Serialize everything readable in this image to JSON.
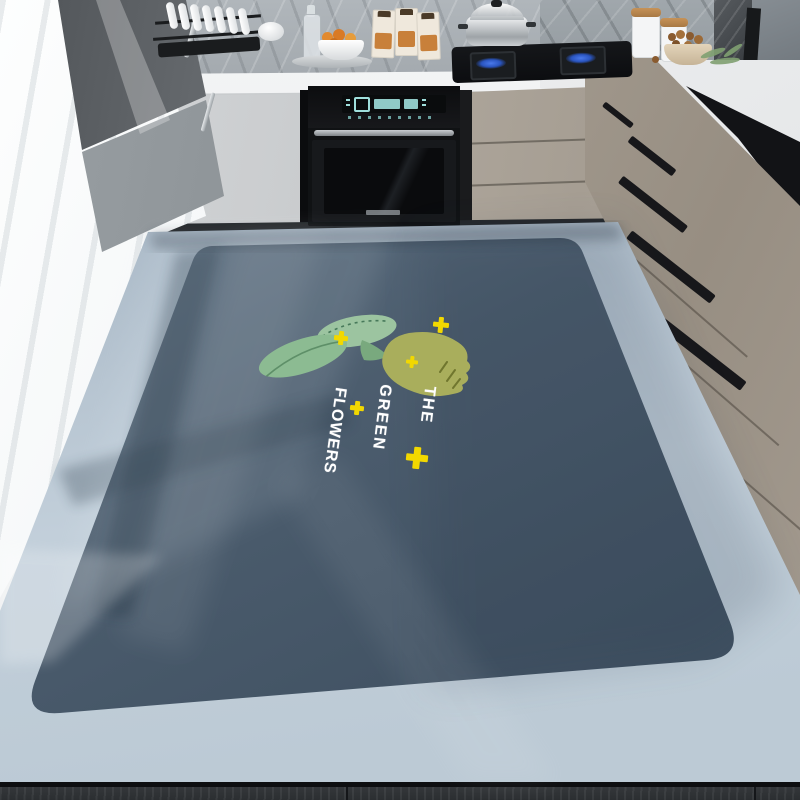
{
  "mat": {
    "text_lines": [
      "THE",
      "GREEN",
      "FLOWERS"
    ],
    "phrase": "THE GREEN FLOWERS",
    "colors": {
      "surface": "#4A5B6C",
      "surface_shadow": "#3A4A5A",
      "border": "#BCC9D4",
      "flower": "#A9AE5C",
      "leaf": "#8FBD95",
      "sparkle": "#F2D800",
      "text": "#FFFFFF"
    },
    "sparkles": [
      {
        "x": 441,
        "y": 325,
        "size": 8
      },
      {
        "x": 341,
        "y": 338,
        "size": 7
      },
      {
        "x": 412,
        "y": 362,
        "size": 6
      },
      {
        "x": 357,
        "y": 408,
        "size": 7
      },
      {
        "x": 417,
        "y": 458,
        "size": 11
      }
    ]
  },
  "kitchen": {
    "objects": [
      "dish-rack",
      "plates",
      "glass-carafe",
      "fruit-bowl",
      "serving-tray",
      "juice-cartons",
      "gas-stove",
      "steamer-pot",
      "built-in-oven",
      "oven-display",
      "storage-canisters",
      "nut-bowl",
      "herbs",
      "window",
      "white-tall-cabinets",
      "taupe-drawer-cabinets",
      "marble-backsplash",
      "countertop",
      "tile-floor",
      "dark-wood-floor"
    ]
  }
}
